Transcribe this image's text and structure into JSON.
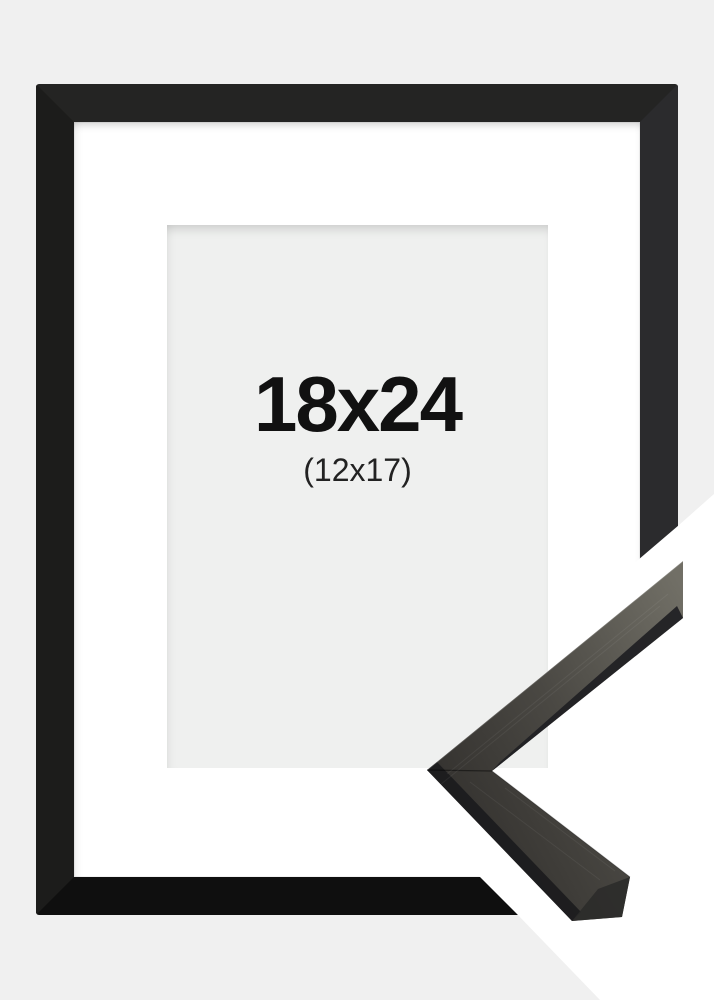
{
  "page": {
    "background_color": "#f0f0f0"
  },
  "frame_product": {
    "size_label": "18x24",
    "inner_size_label": "(12x17)",
    "frame_color": "#1b1b1b",
    "mat_color": "#ffffff",
    "picture_area_color": "#eff0ef",
    "corner_sample_wood_dark": "#34322f",
    "corner_sample_wood_mid": "#4a4843",
    "corner_sample_wood_light": "#716f66",
    "backdrop_color": "#ffffff"
  }
}
